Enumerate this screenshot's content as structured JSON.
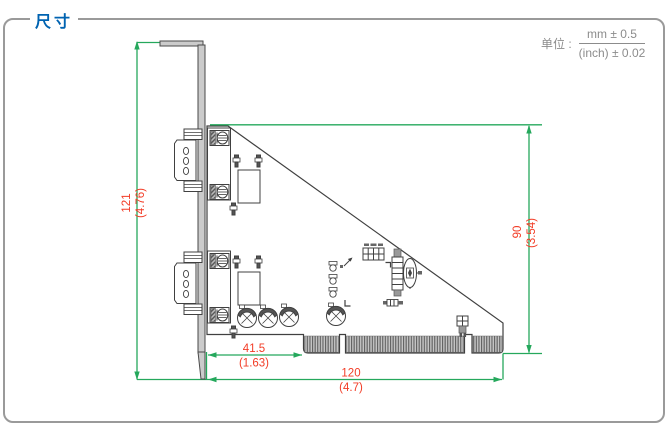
{
  "header": {
    "title": "尺寸"
  },
  "unit_note": {
    "label": "单位 :",
    "metric": "mm ± 0.5",
    "imperial": "(inch) ± 0.02"
  },
  "dimensions": {
    "bracket_height_mm": "121",
    "bracket_height_inch": "(4.76)",
    "board_height_mm": "90",
    "board_height_inch": "(3.54)",
    "connector_offset_mm": "41.5",
    "connector_offset_inch": "(1.63)",
    "board_length_mm": "120",
    "board_length_inch": "(4.7)"
  },
  "colors": {
    "title_blue": "#0063b1",
    "dimension_green": "#25a85c",
    "dimension_text_red": "#f23c26",
    "frame_border_gray": "#9a9a9a",
    "drawing_outline": "#404040"
  }
}
